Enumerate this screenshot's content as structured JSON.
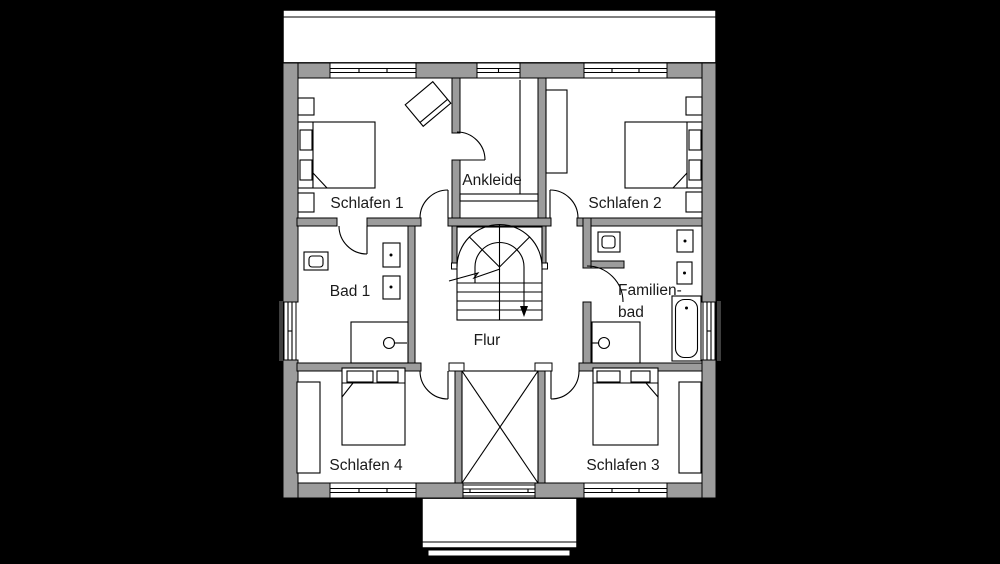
{
  "plan": {
    "type": "upper-floor-plan",
    "rooms": {
      "schlafen1": "Schlafen 1",
      "ankleide": "Ankleide",
      "schlafen2": "Schlafen 2",
      "bad1": "Bad 1",
      "familienbad_line1": "Familien-",
      "familienbad_line2": "bad",
      "flur": "Flur",
      "schlafen4": "Schlafen 4",
      "schlafen3": "Schlafen 3"
    },
    "colors": {
      "background": "#000000",
      "floor": "#ffffff",
      "wall": "#9c9c9c",
      "line": "#000000",
      "text": "#1a1a1a"
    }
  }
}
